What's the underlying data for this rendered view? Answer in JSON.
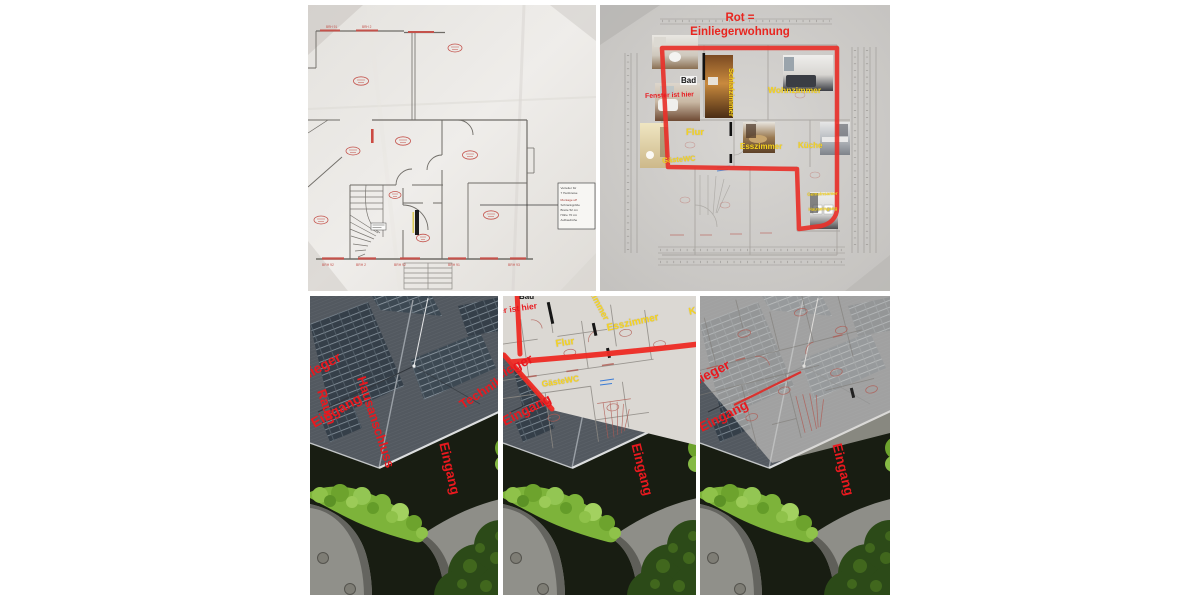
{
  "colors": {
    "annotation_red": "#e8191f",
    "label_yellow": "#f6d41f",
    "plan_red": "#c4524b",
    "marker_red": "#ee2b24"
  },
  "plan_original": {
    "note_lines": [
      "Verteiler für",
      "7 Heizkreise",
      "Montage uP",
      "Schrankgröße",
      "Breite 52 cm",
      "Höhe 70 cm",
      "Aufbauhöhe"
    ],
    "dim_labels_bottom": [
      "BRH 92",
      "BRH 2",
      "BRH 92",
      "BRH 91",
      "BRH 93"
    ],
    "dim_labels_top": [
      "BRH 91",
      "BRH 2"
    ]
  },
  "plan_marked": {
    "title_line1": "Rot =",
    "title_line2": "Einliegerwohnung",
    "label_bad": "Bad",
    "label_fenster": "Fenster ist hier",
    "label_schlafzimmer": "Schlafzimmer",
    "label_wohnzimmer": "Wohnzimmer",
    "label_flur": "Flur",
    "label_esszimmer": "Esszimmer",
    "label_kueche": "Küche",
    "label_gaestewc": "GästeWC",
    "label_corner_line1": "Gemeinsamer",
    "label_corner_line2": "Hauseingang"
  },
  "aerial_left": {
    "label_edge_line1": "Einlieger",
    "label_edge_line2": "Eingang",
    "label_haus_line1": "Hausanschluss",
    "label_haus_line2": "Raum",
    "label_technik": "Technikraum",
    "label_eingang": "Eingang"
  },
  "aerial_middle": {
    "label_fenster": "Fenster ist hier",
    "label_bad": "Bad",
    "label_schlafzimmer": "Schlafzimmer",
    "label_flur": "Flur",
    "label_esszimmer": "Esszimmer",
    "label_gaestewc": "GästeWC",
    "label_kueche": "Küche",
    "label_edge_line1": "Einlieger",
    "label_edge_line2": "Eingang",
    "label_eingang": "Eingang"
  },
  "aerial_right": {
    "label_edge_line1": "Einlieger",
    "label_edge_line2": "Eingang",
    "label_eingang": "Eingang"
  }
}
